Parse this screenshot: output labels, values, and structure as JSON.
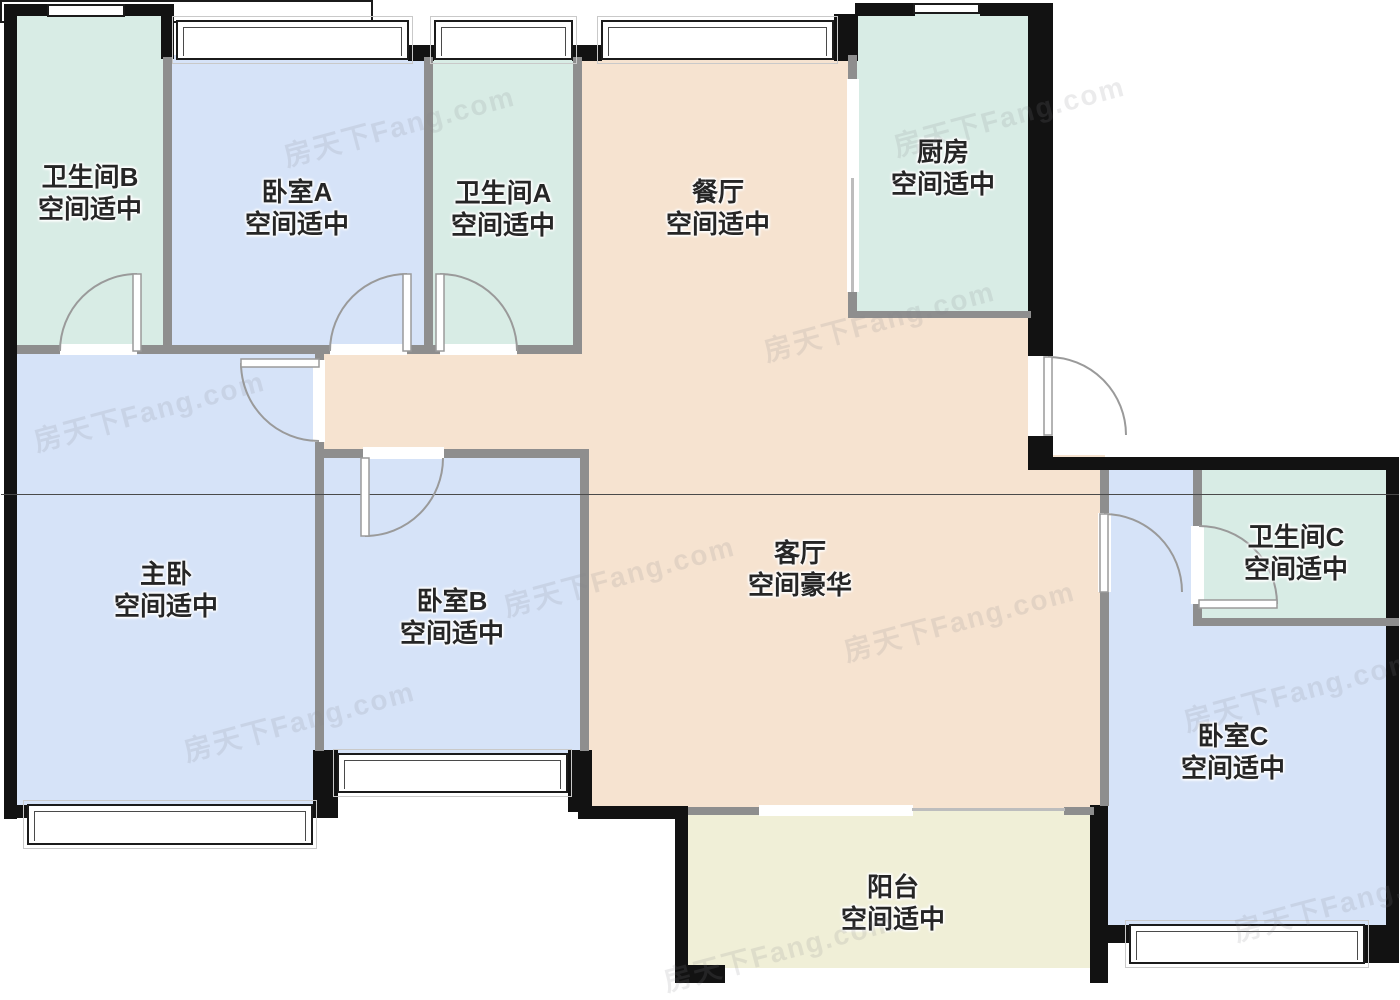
{
  "watermark": {
    "text": "房天下Fang.com"
  },
  "colors": {
    "bedroom": "#d6e3f8",
    "bathroom_kitchen": "#d8ece5",
    "living_dining": "#f6e3d0",
    "balcony": "#f0efd7",
    "exterior_wall": "#121212",
    "interior_wall": "#8e8e8e"
  },
  "rooms": [
    {
      "id": "bathroom-b",
      "name": "卫生间B",
      "quality": "空间适中"
    },
    {
      "id": "bedroom-a",
      "name": "卧室A",
      "quality": "空间适中"
    },
    {
      "id": "bathroom-a",
      "name": "卫生间A",
      "quality": "空间适中"
    },
    {
      "id": "dining-room",
      "name": "餐厅",
      "quality": "空间适中"
    },
    {
      "id": "kitchen",
      "name": "厨房",
      "quality": "空间适中"
    },
    {
      "id": "master-bedroom",
      "name": "主卧",
      "quality": "空间适中"
    },
    {
      "id": "bedroom-b",
      "name": "卧室B",
      "quality": "空间适中"
    },
    {
      "id": "living-room",
      "name": "客厅",
      "quality": "空间豪华"
    },
    {
      "id": "bathroom-c",
      "name": "卫生间C",
      "quality": "空间适中"
    },
    {
      "id": "bedroom-c",
      "name": "卧室C",
      "quality": "空间适中"
    },
    {
      "id": "balcony",
      "name": "阳台",
      "quality": "空间适中"
    }
  ]
}
